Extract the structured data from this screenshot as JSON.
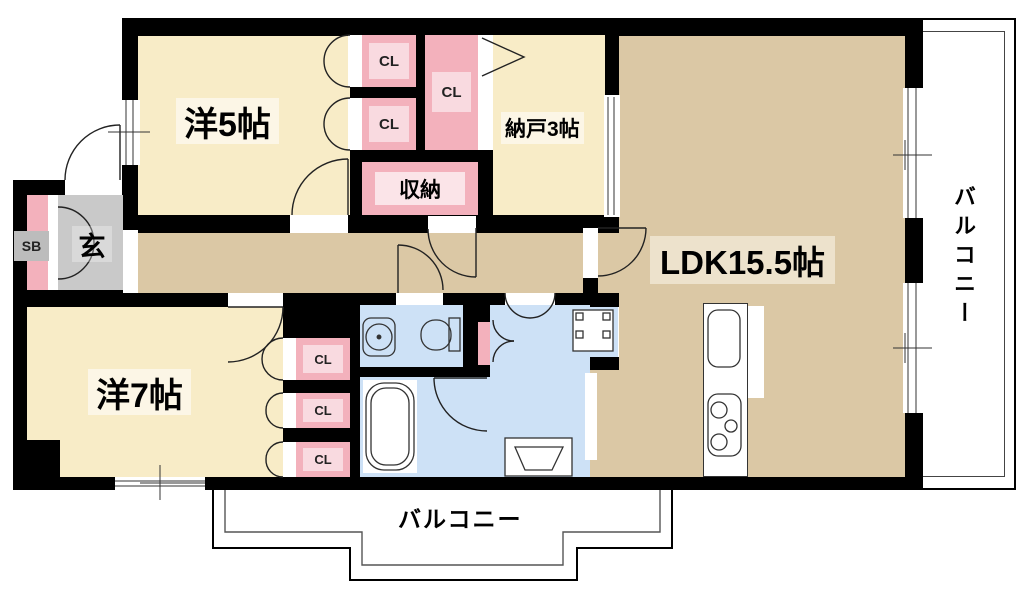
{
  "labels": {
    "bedroom5": "洋5帖",
    "bedroom7": "洋7帖",
    "ldk": "LDK15.5帖",
    "storage_room": "納戸3帖",
    "storage": "収納",
    "closet": "CL",
    "entrance": "玄",
    "shoe_box": "SB",
    "balcony": "バルコニー"
  },
  "colors": {
    "wall": "#000000",
    "room_cream": "#F8ECC7",
    "floor_tan": "#DBC8A5",
    "closet_pink": "#F3B1BC",
    "closet_pink_light": "#F9DAE0",
    "water_blue": "#CDE1F6",
    "entrance_gray": "#C9C9C9",
    "fixture_line": "#333333"
  }
}
